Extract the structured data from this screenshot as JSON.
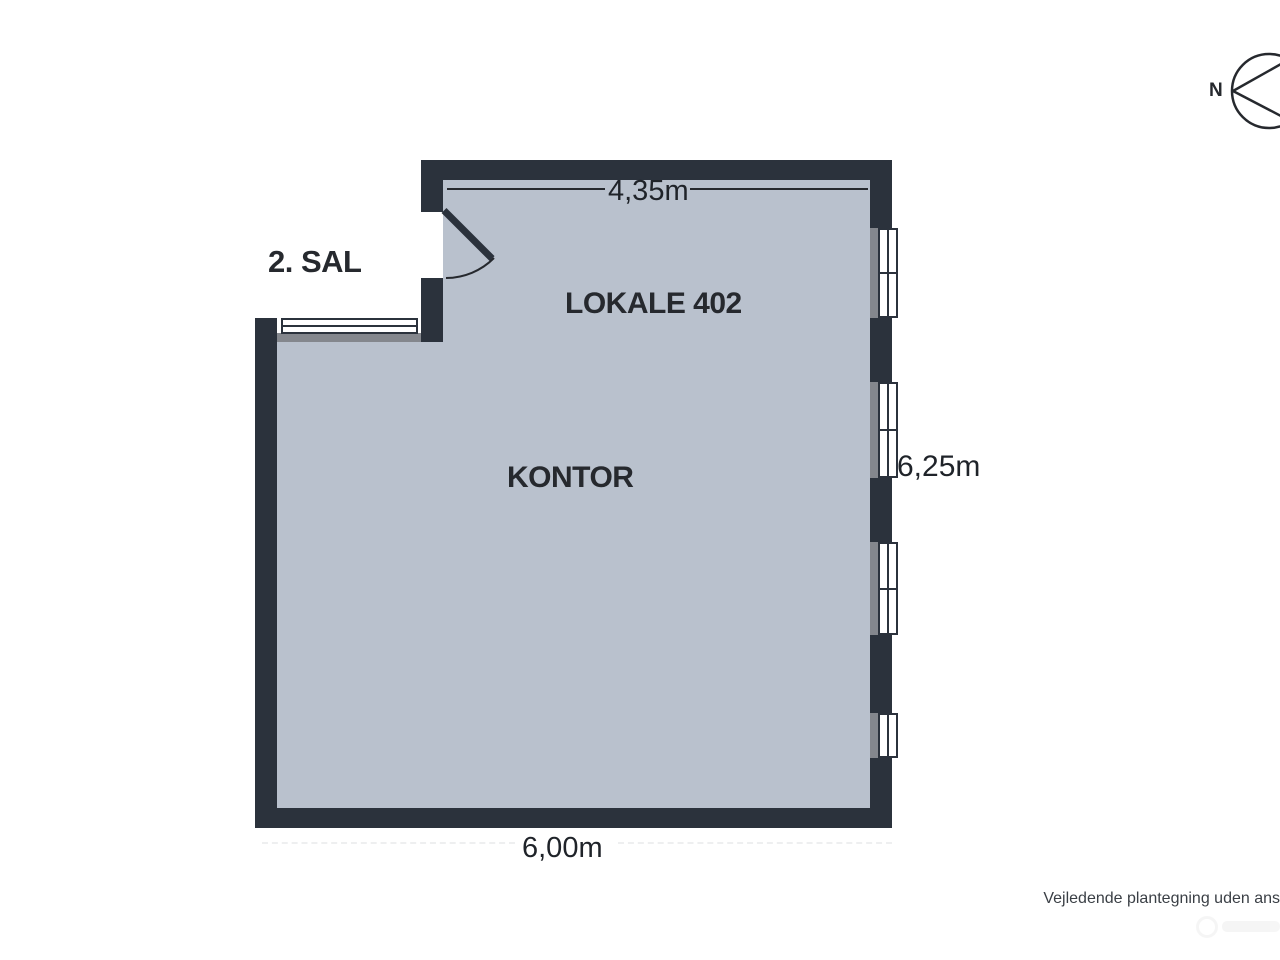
{
  "plan": {
    "floor_label": "2. SAL",
    "room_name": "LOKALE 402",
    "room_type": "KONTOR",
    "dim_top": "4,35m",
    "dim_right": "6,25m",
    "dim_bottom": "6,00m"
  },
  "compass": {
    "north_label": "N"
  },
  "footer": {
    "disclaimer": "Vejledende plantegning uden ans"
  },
  "colors": {
    "wall": "#2b323c",
    "floor": "#b9c1cd",
    "window_sill": "#84878d",
    "window_frame": "#2b323c",
    "dimension_line": "#26292e",
    "label_text": "#26292e",
    "dimension_text": "#1f2329",
    "disclaimer_text": "#3a3f45",
    "background": "#ffffff"
  }
}
